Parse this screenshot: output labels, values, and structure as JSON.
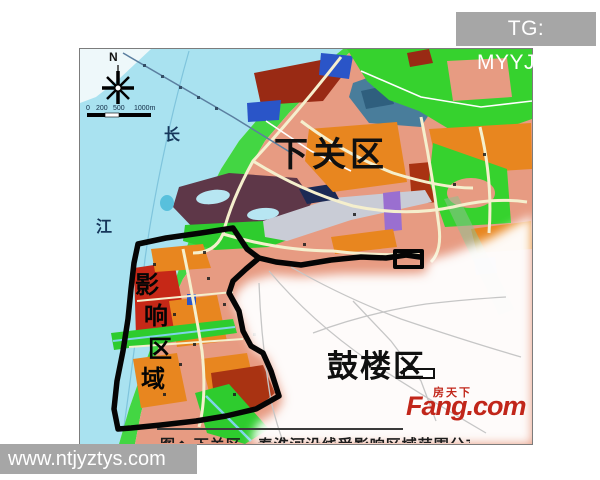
{
  "watermarks": {
    "telegram": "TG: MYYJJPP",
    "website": "www.ntjyztys.com",
    "box_color": "#a6a6a6"
  },
  "map": {
    "compass_north": "N",
    "scale_labels": [
      "0",
      "200",
      "500",
      "1000m"
    ],
    "river_name_chars": [
      "长",
      "江"
    ],
    "district_labels": {
      "xiaguan": "下关区",
      "gulou": "鼓楼区"
    },
    "affected_area_chars": [
      "影",
      "响",
      "区",
      "域"
    ],
    "caption": "图◆ 下关区、秦淮河沿线受影响区域范围分布图",
    "logo": {
      "cn": "房天下",
      "en": "Fang.com",
      "color": "#c1261a"
    },
    "colors": {
      "river": "#a9e2f0",
      "bank_green": "#43d643",
      "city_salmon": "#e79b82",
      "boundary": "#050505",
      "railway_gray": "#c9ccd6"
    }
  }
}
